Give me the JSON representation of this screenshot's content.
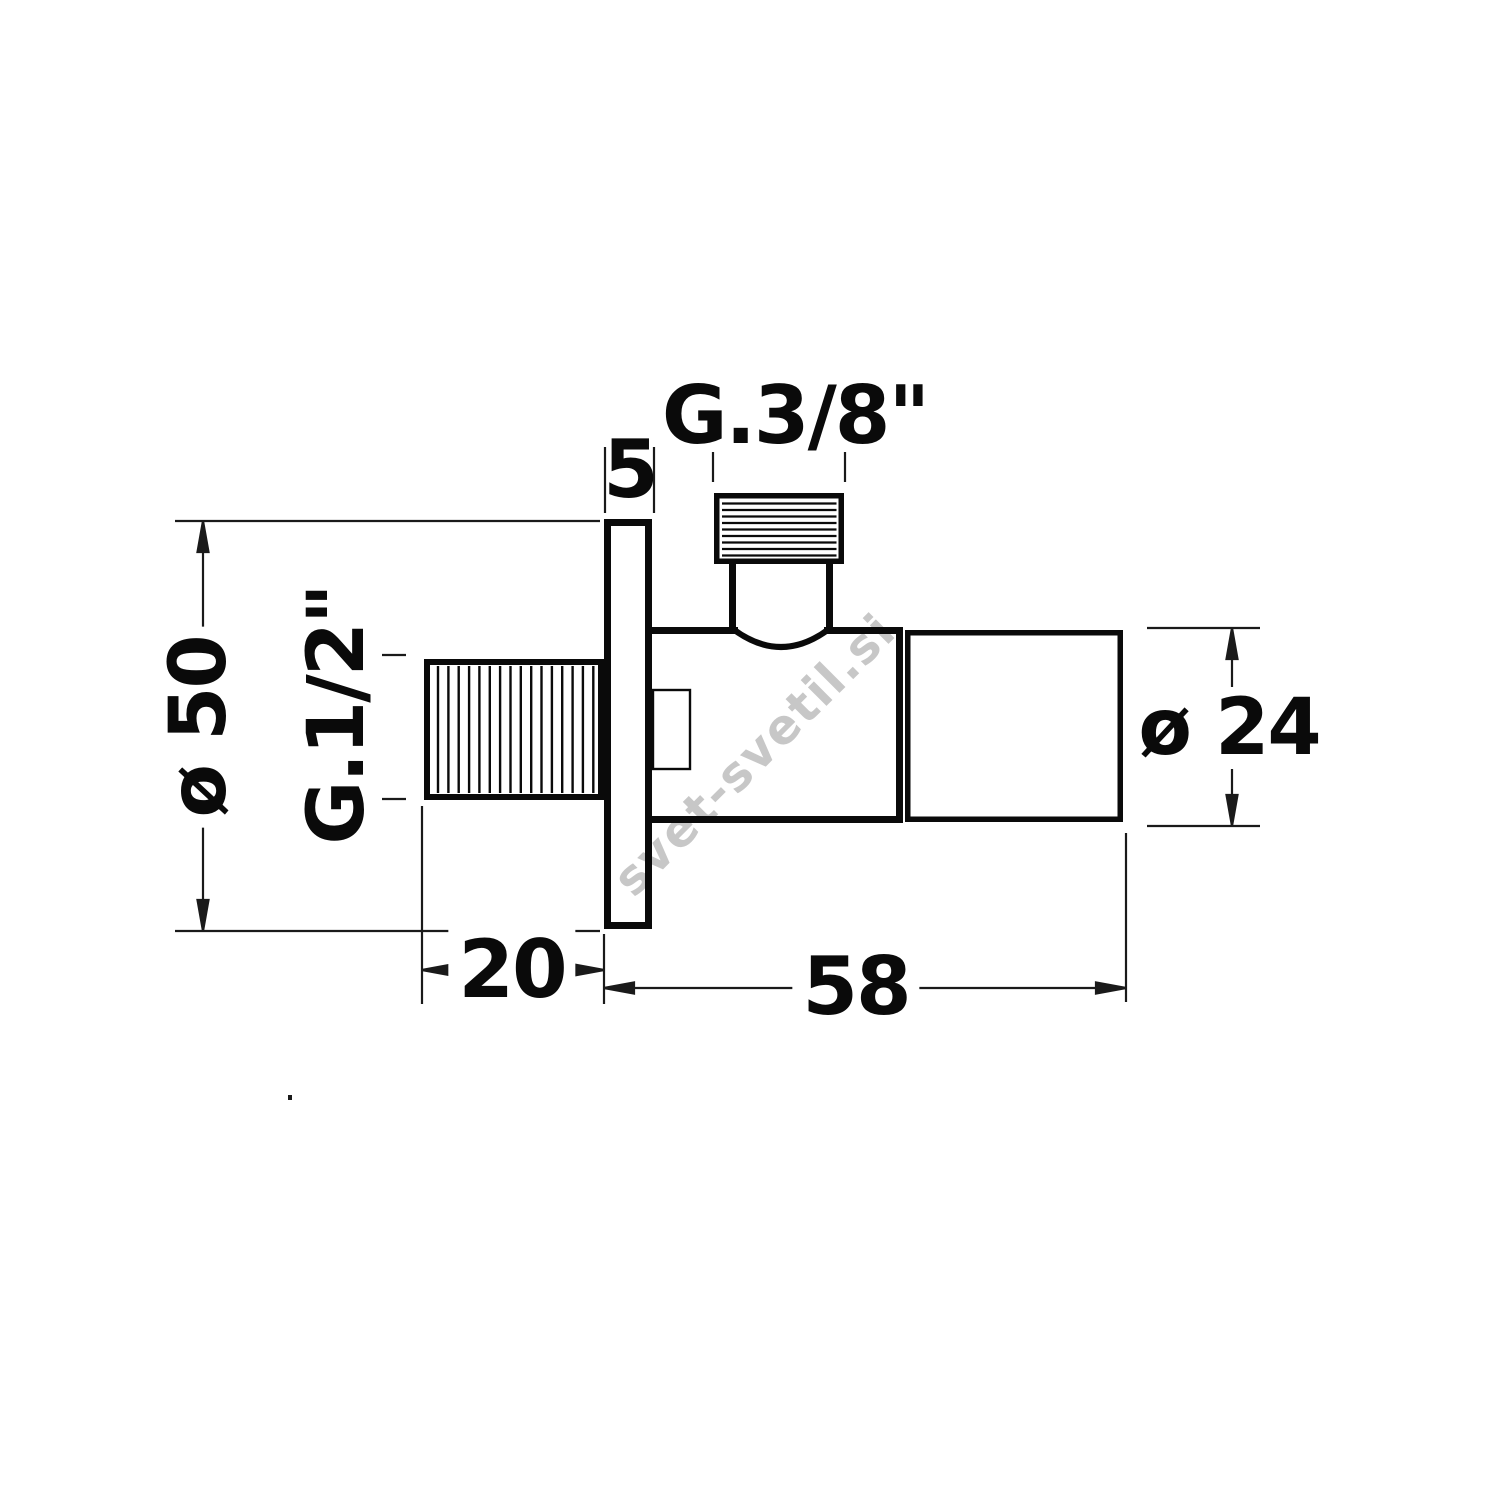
{
  "title": "Angle valve technical drawing",
  "watermark": "svet-svetil.si",
  "dimensions": {
    "top_thread_label": "G.3/8\"",
    "inlet_thread_label": "G.1/2\"",
    "flange_thickness": "5",
    "flange_diameter": "ø 50",
    "body_diameter": "ø 24",
    "inlet_length": "20",
    "body_length": "58"
  },
  "colors": {
    "line": "#0a0a0a",
    "background": "#ffffff",
    "watermark": "#c7c7c7"
  }
}
